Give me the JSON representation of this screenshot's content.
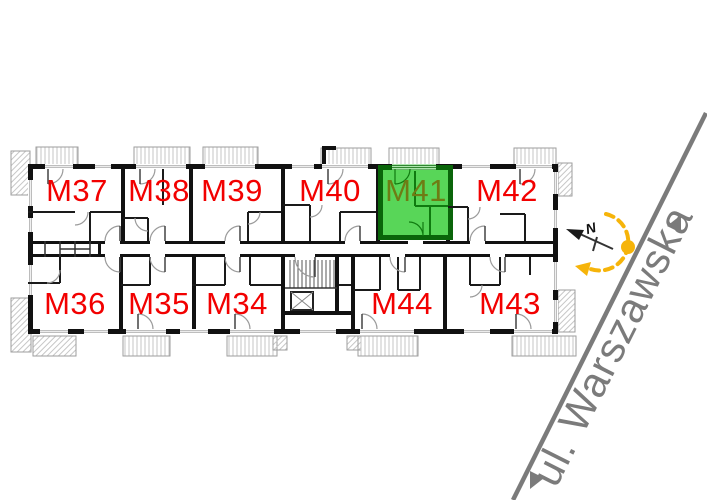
{
  "plan": {
    "highlighted_unit": "M41",
    "units": [
      {
        "label": "M37",
        "row": "top",
        "highlighted": false
      },
      {
        "label": "M38",
        "row": "top",
        "highlighted": false
      },
      {
        "label": "M39",
        "row": "top",
        "highlighted": false
      },
      {
        "label": "M40",
        "row": "top",
        "highlighted": false
      },
      {
        "label": "M41",
        "row": "top",
        "highlighted": true
      },
      {
        "label": "M42",
        "row": "top",
        "highlighted": false
      },
      {
        "label": "M36",
        "row": "bottom",
        "highlighted": false
      },
      {
        "label": "M35",
        "row": "bottom",
        "highlighted": false
      },
      {
        "label": "M34",
        "row": "bottom",
        "highlighted": false
      },
      {
        "label": "M44",
        "row": "bottom",
        "highlighted": false
      },
      {
        "label": "M43",
        "row": "bottom",
        "highlighted": false
      }
    ]
  },
  "street": {
    "name": "ul. Warszawska"
  },
  "compass": {
    "north_label": "N"
  },
  "colors": {
    "unit_label_red": "#f20000",
    "highlight_fill": "#58d658",
    "highlight_wall": "#0a650a",
    "highlight_label": "#6e7c14",
    "street_gray": "#7b7b7b",
    "accent_yellow": "#f6b40a"
  }
}
